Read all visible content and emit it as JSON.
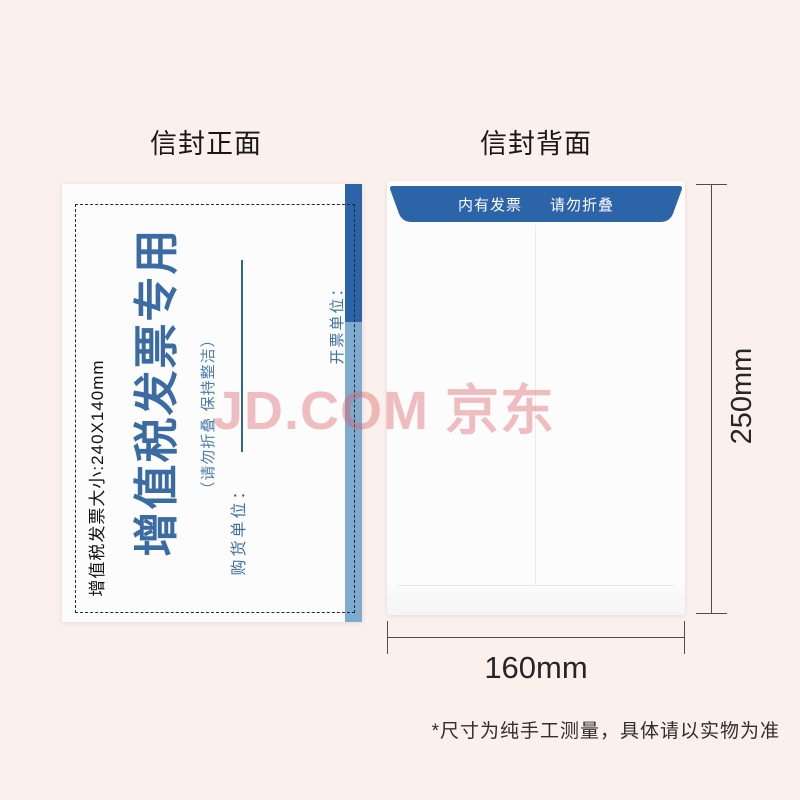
{
  "page": {
    "watermark": "JD.COM 京东",
    "disclaimer": "*尺寸为纯手工测量，具体请以实物为准"
  },
  "front": {
    "title": "信封正面",
    "size_note": "增值税发票大小:240X140mm",
    "envelope": {
      "main_text": "增值税发票专用",
      "sub_text": "（请勿折叠 保持整洁）",
      "buyer_label": "购货单位：",
      "issuer_label": "开票单位："
    }
  },
  "back": {
    "title": "信封背面",
    "flap_left": "内有发票",
    "flap_right": "请勿折叠"
  },
  "dimensions": {
    "height_label": "250mm",
    "width_label": "160mm"
  },
  "colors": {
    "background_pink": "#fcf0ed",
    "flap_dark_blue": "#2b64a8",
    "strip_light_blue": "#7fabcf",
    "envelope_text_blue": "#3a6ca3",
    "watermark_pink": "#dd5f63"
  }
}
